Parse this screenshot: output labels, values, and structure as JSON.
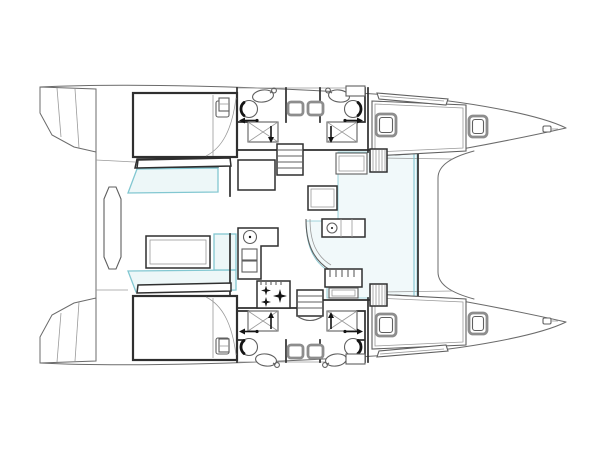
{
  "app": {
    "type": "yacht-floorplan-drawing",
    "background": "#ffffff"
  },
  "canvas": {
    "width": 600,
    "height": 450
  },
  "colors": {
    "background": "#ffffff",
    "outline": "#6b6b6b",
    "wall": "#2f2f2f",
    "furniture": "#5f5f5f",
    "light_line": "#9a9a9a",
    "accent_stroke": "#82c7d1",
    "accent_fill": "#edf7f8",
    "floor_tint": "#f1f9fa",
    "arrow": "#141414",
    "hatch_frame": "#8d8d8d"
  },
  "plan": {
    "vessel": "catamaran",
    "view": "top-down interior layout plan",
    "bow_direction": "right",
    "stern_direction": "left",
    "hulls": {
      "port": {
        "position": "top",
        "spaces": [
          "aft-cabin-double-berth",
          "aft-head-with-shower",
          "stair-corridor",
          "forward-head-with-shower",
          "forward-cabin-berth"
        ]
      },
      "starboard": {
        "position": "bottom",
        "spaces": [
          "aft-cabin-double-berth",
          "aft-head-with-shower",
          "stair-corridor",
          "forward-head-with-shower",
          "forward-cabin-berth"
        ]
      }
    },
    "bridgedeck": {
      "spaces": [
        "salon",
        "galley-l-counter",
        "stove-4-burner",
        "salon-table",
        "side-counter-with-sink",
        "curved-settee",
        "entry-bench",
        "companionway-steps",
        "hull-staircases"
      ]
    },
    "cockpit": {
      "spaces": [
        "port-bench-seat",
        "cockpit-table",
        "l-shaped-settee",
        "aft-helm-bench"
      ]
    },
    "stern": {
      "spaces": [
        "port-transom-steps",
        "starboard-transom-steps"
      ]
    },
    "fixtures": [
      "toilet",
      "oval-sink-with-tap",
      "shower-stall",
      "deck-hatch",
      "skylight",
      "wardrobe-hatched",
      "door-swing-arrow",
      "bow-cleat"
    ]
  }
}
